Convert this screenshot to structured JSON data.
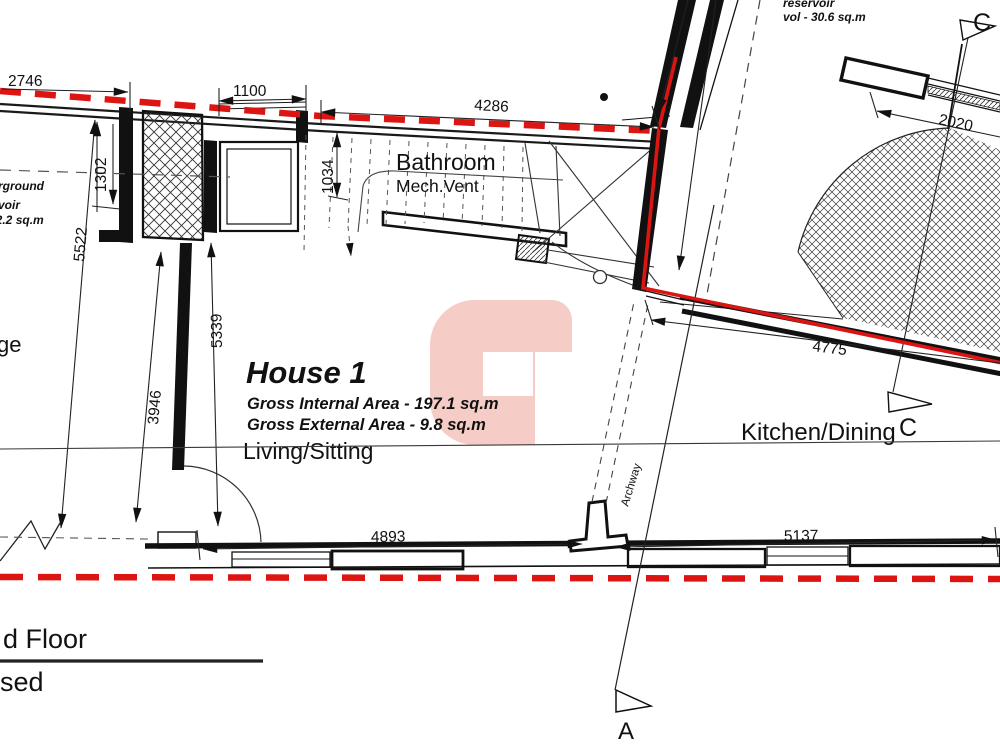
{
  "drawing": {
    "house": {
      "name": "House 1",
      "internal_area": "Gross Internal Area - 197.1 sq.m",
      "external_area": "Gross External Area - 9.8 sq.m"
    },
    "rooms": {
      "bathroom": "Bathroom",
      "mech_vent": "Mech.Vent",
      "living": "Living/Sitting",
      "kitchen": "Kitchen/Dining",
      "garage_fragment": "ge",
      "archway": "Archway"
    },
    "notes": {
      "reservoir_top_1": "reservoir",
      "reservoir_top_2": "vol - 30.6 sq.m",
      "reservoir_left_1": "rground",
      "reservoir_left_2": "voir",
      "reservoir_left_3": "92.2 sq.m"
    },
    "sections": {
      "a": "A",
      "c": "C"
    },
    "dimensions": {
      "d2746": "2746",
      "d1100": "1100",
      "d4286": "4286",
      "d1302": "1302",
      "d1034": "1034",
      "d5522": "5522",
      "d5339": "5339",
      "d3946": "3946",
      "d4893": "4893",
      "d5137": "5137",
      "d4775": "4775",
      "d2020": "2020"
    },
    "title_block": {
      "floor_label": "d Floor",
      "proposed_label": "sed"
    },
    "colors": {
      "boundary_red": "#dd1512",
      "watermark_pink": "#f6cdc6",
      "line_black": "#1a1a1a"
    }
  }
}
